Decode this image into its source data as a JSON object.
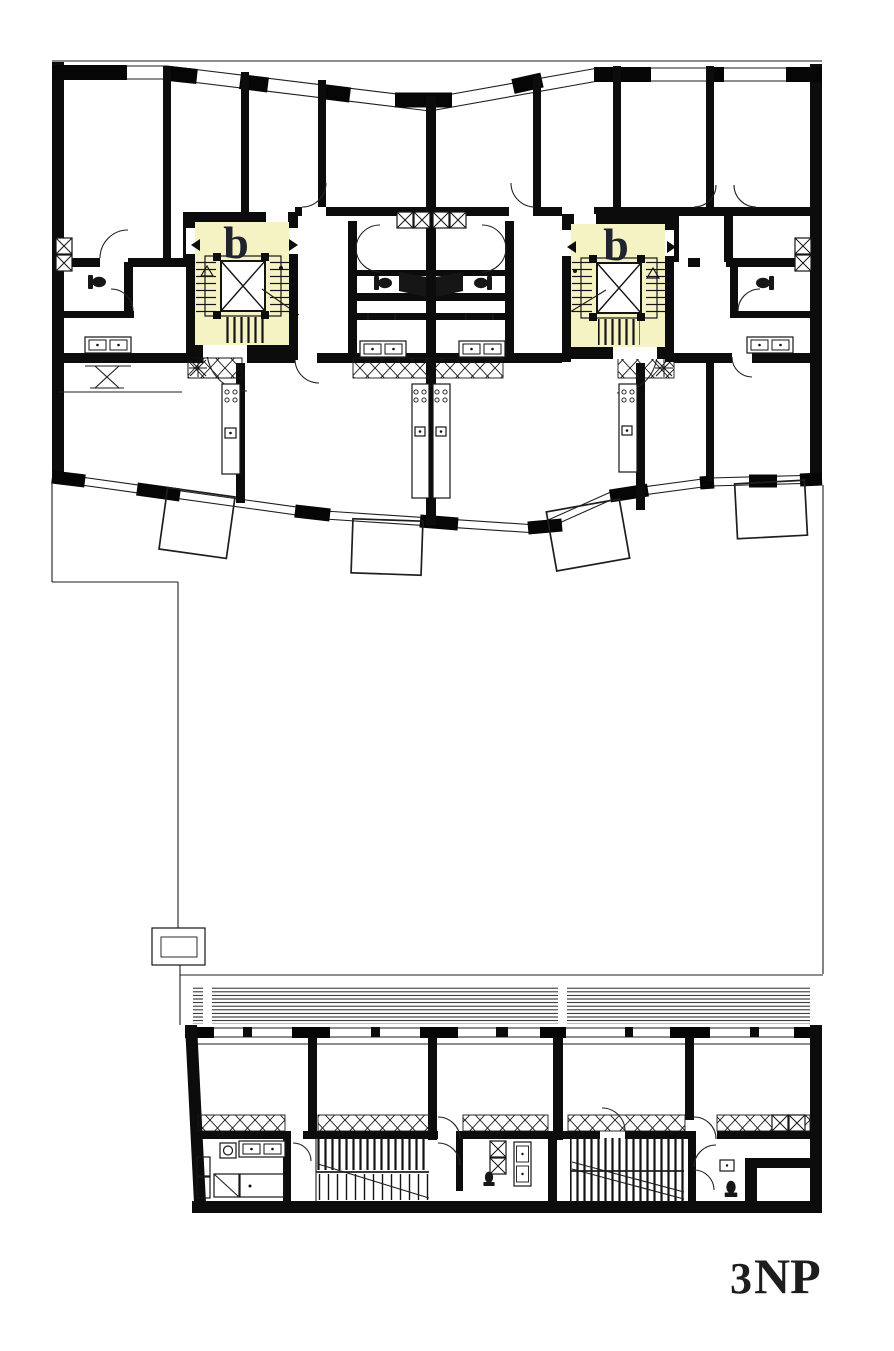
{
  "document": {
    "type": "architectural-floor-plan",
    "floor_label": {
      "number": "3",
      "suffix": "NP"
    },
    "cores": {
      "left": {
        "label": "b"
      },
      "right": {
        "label": "b"
      }
    },
    "colors": {
      "background": "#ffffff",
      "walls": "#0c0c0c",
      "highlight": "#f5f2c3",
      "core_label": "#20242e",
      "floor_label": "#1d1d1d"
    }
  }
}
